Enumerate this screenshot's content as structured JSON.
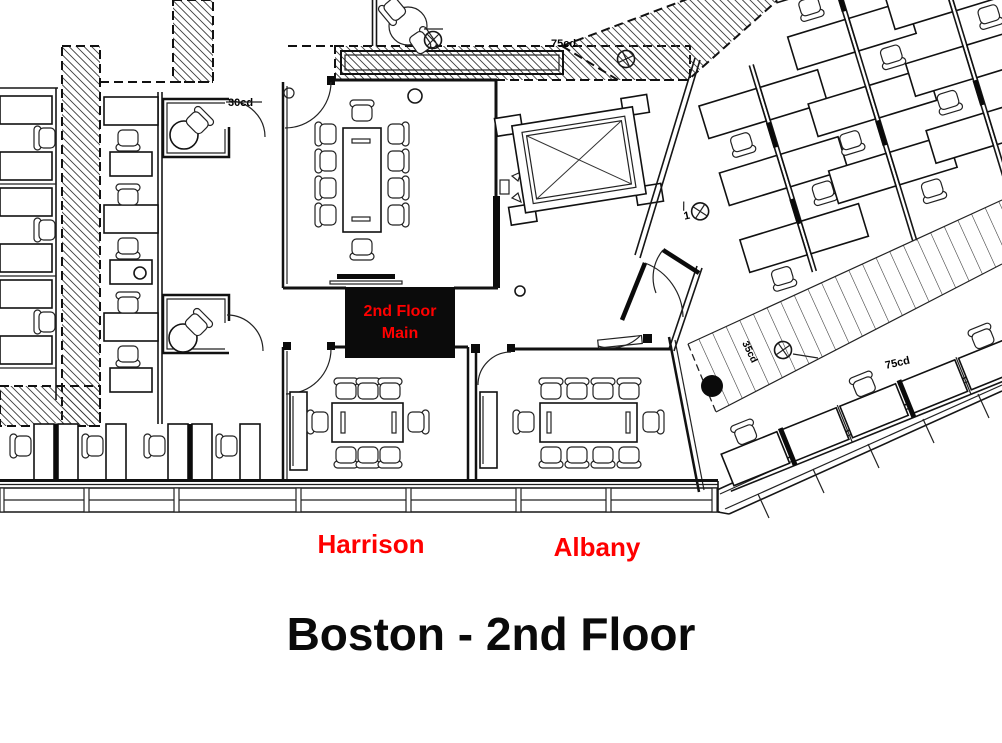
{
  "title": "Boston - 2nd Floor",
  "rooms": {
    "harrison": "Harrison",
    "albany": "Albany",
    "main_marker_line1": "2nd Floor",
    "main_marker_line2": "Main"
  },
  "annotations": {
    "door_top_left": "30cd",
    "window_top": "75cd",
    "window_right": "75cd",
    "walkway": "35cd",
    "fixture_count": "1"
  },
  "colors": {
    "label_red": "#ff0000",
    "ink": "#111111",
    "paper": "#ffffff"
  }
}
